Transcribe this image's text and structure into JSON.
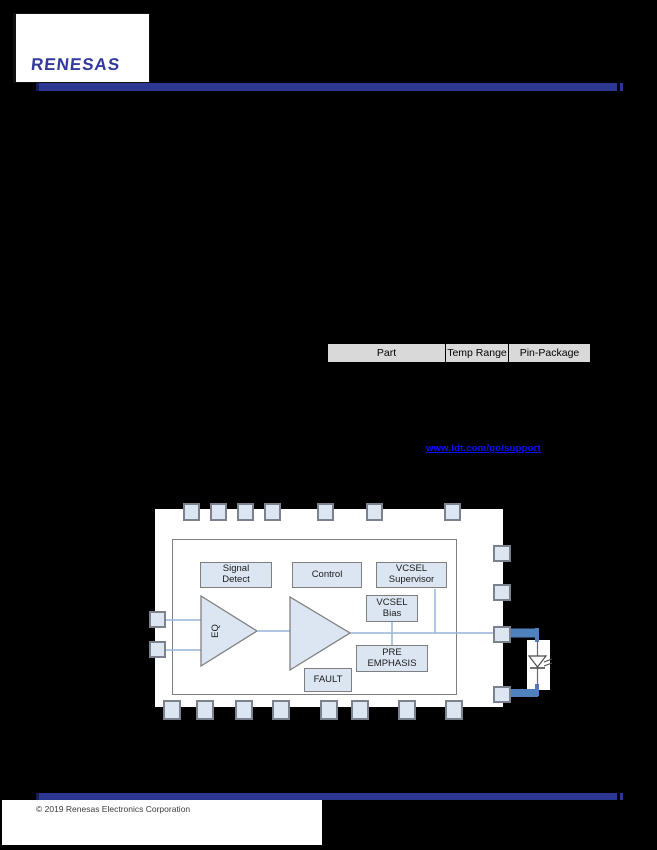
{
  "header": {
    "logo": "RENESAS"
  },
  "ordering_table": {
    "columns": [
      "Part",
      "Temp Range",
      "Pin-Package"
    ]
  },
  "order_link": {
    "text": "www.idt.com/go/support"
  },
  "block_diagram": {
    "blocks": {
      "signal_detect": "Signal Detect",
      "control": "Control",
      "vcsel_supervisor": "VCSEL Supervisor",
      "vcsel_bias": "VCSEL Bias",
      "pre_emphasis": "PRE EMPHASIS",
      "fault": "FAULT",
      "eq": "EQ"
    }
  },
  "footer": {
    "copyright": "© 2019 Renesas Electronics Corporation"
  },
  "colors": {
    "accent_bar": "#2c3792",
    "logo_blue": "#323a9c",
    "link_blue": "#0d0dff",
    "pad_fill": "#dce6f2",
    "thin_line_blue": "#95b3d7",
    "thick_line_blue": "#4f81bd",
    "table_header_bg": "#d9d9d9"
  }
}
